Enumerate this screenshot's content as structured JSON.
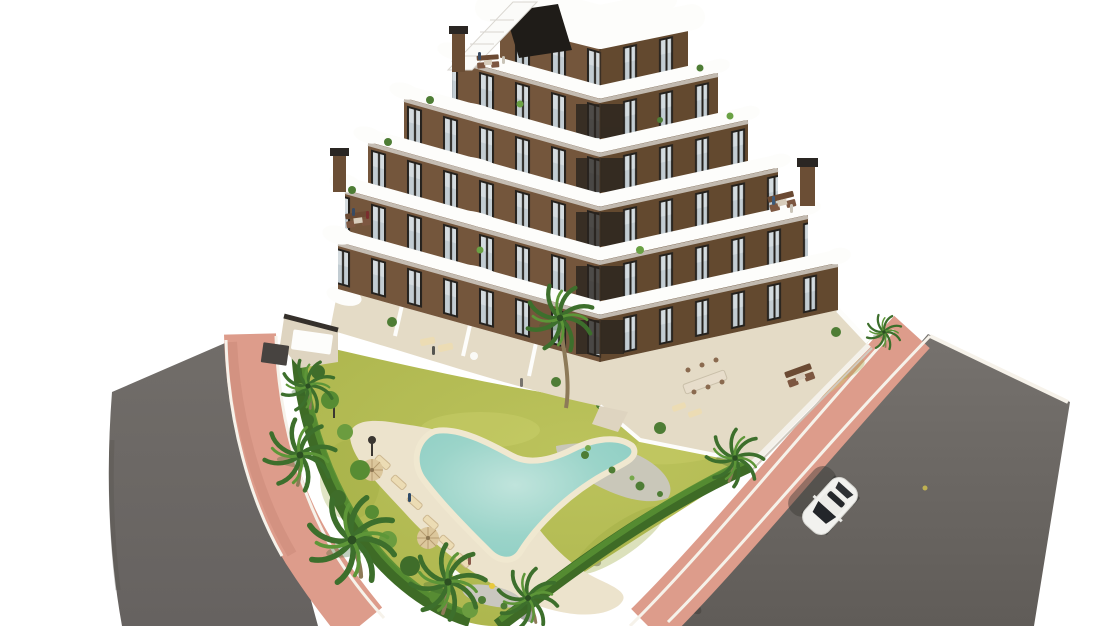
{
  "meta": {
    "domain": "natural-image",
    "description": "Aerial 3D architectural rendering of a modern apartment complex: V-shaped brown building with curved white balcony bands, roof terraces, garden with free-form pool, palm trees, pink sidewalks, asphalt roads and one white car on a white background"
  },
  "palette": {
    "background": "#ffffff",
    "road": "#6c6864",
    "road_light": "#7d7975",
    "road_dark": "#5e5a56",
    "sidewalk_pink": "#dd9c8b",
    "sidewalk_pink_dark": "#c98878",
    "curb_white": "#f6f2ea",
    "lawn": "#b5bd55",
    "lawn_light": "#cdd26e",
    "lawn_dark": "#9aa83f",
    "hedge": "#3e6b26",
    "hedge_light": "#578f33",
    "bush_green": "#4e7d35",
    "palm_green": "#3d6f2c",
    "palm_light": "#5d9638",
    "trunk": "#8d7a58",
    "pool_water": "#8ccdc3",
    "pool_water_light": "#c0e4dc",
    "pool_rim": "#f0e8d0",
    "deck_sand": "#ece3cc",
    "gravel": "#c9c7bf",
    "terrace_beige": "#e4dbc6",
    "roof_patch": "#e9e2d2",
    "wall_brown": "#74563c",
    "wall_brown_dark": "#63492f",
    "window_frame": "#24211d",
    "window_glass": "#c2ccd2",
    "slab_white": "#fdfdfb",
    "slab_shadow": "#d9d6d0",
    "wall_white": "#f4f1ea",
    "furniture_brown": "#6b4a33",
    "furniture_tan": "#ecdcb4",
    "umbrella_tan": "#dcc79c",
    "car_white": "#f2f2ef",
    "car_glass": "#23262a",
    "shadow": "#3c3935",
    "gate_dark": "#474340"
  },
  "scene": {
    "building": {
      "floors_visible": 6,
      "wings": 2,
      "chimneys": 3,
      "roof_terraces": 4,
      "balcony_style": "curved-white-bands"
    },
    "pool": {
      "shape": "freeform-boomerang",
      "sun_loungers": 6,
      "parasols": 2
    },
    "vegetation": {
      "palm_trees": 8,
      "hedge": "perimeter",
      "lawn": "yellow-green"
    },
    "roads": {
      "left_road": 1,
      "right_road": 1,
      "sidewalk": "pink-ring"
    },
    "vehicles": [
      {
        "type": "car",
        "color": "white",
        "location": "right-road"
      }
    ]
  }
}
